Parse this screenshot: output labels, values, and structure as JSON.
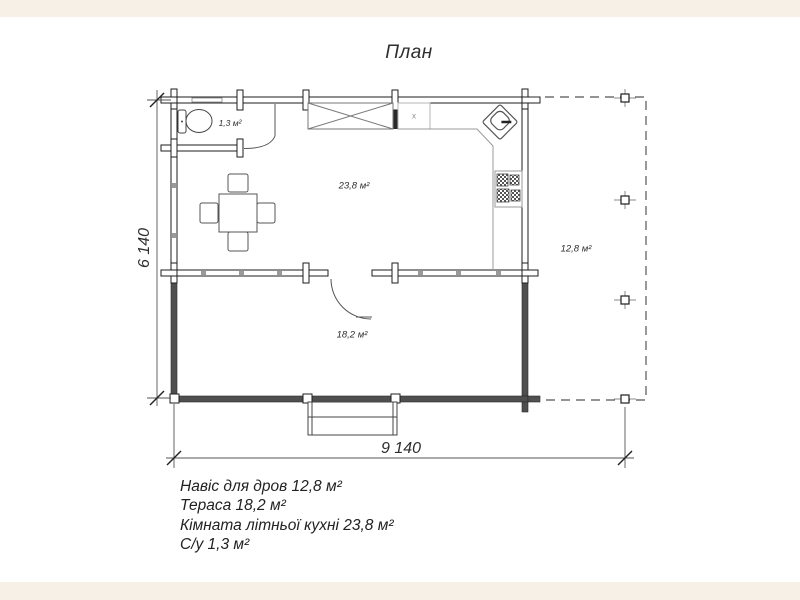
{
  "title": "План",
  "plan": {
    "rooms": [
      {
        "name": "С/у",
        "area_label": "1,3 м²"
      },
      {
        "name": "Кімната літньої кухні",
        "area_label": "23,8 м²"
      },
      {
        "name": "Навіс для дров",
        "area_label": "12,8 м²"
      },
      {
        "name": "Тераса",
        "area_label": "18,2 м²"
      }
    ],
    "kitchen_unit_label": "x",
    "dimensions": {
      "horizontal": "9 140",
      "vertical": "6 140"
    }
  },
  "legend": {
    "lines": [
      "Навіс для дров 12,8 м²",
      "Тераса 18,2 м²",
      "Кімната літньої кухні 23,8 м²",
      "С/у 1,3 м²"
    ]
  },
  "colors": {
    "background": "#ffffff",
    "frame_band": "#f7f0e6",
    "wall_line": "#2a2a2a",
    "terrace_wall": "#4f4f4f",
    "counter_line": "#999999"
  }
}
